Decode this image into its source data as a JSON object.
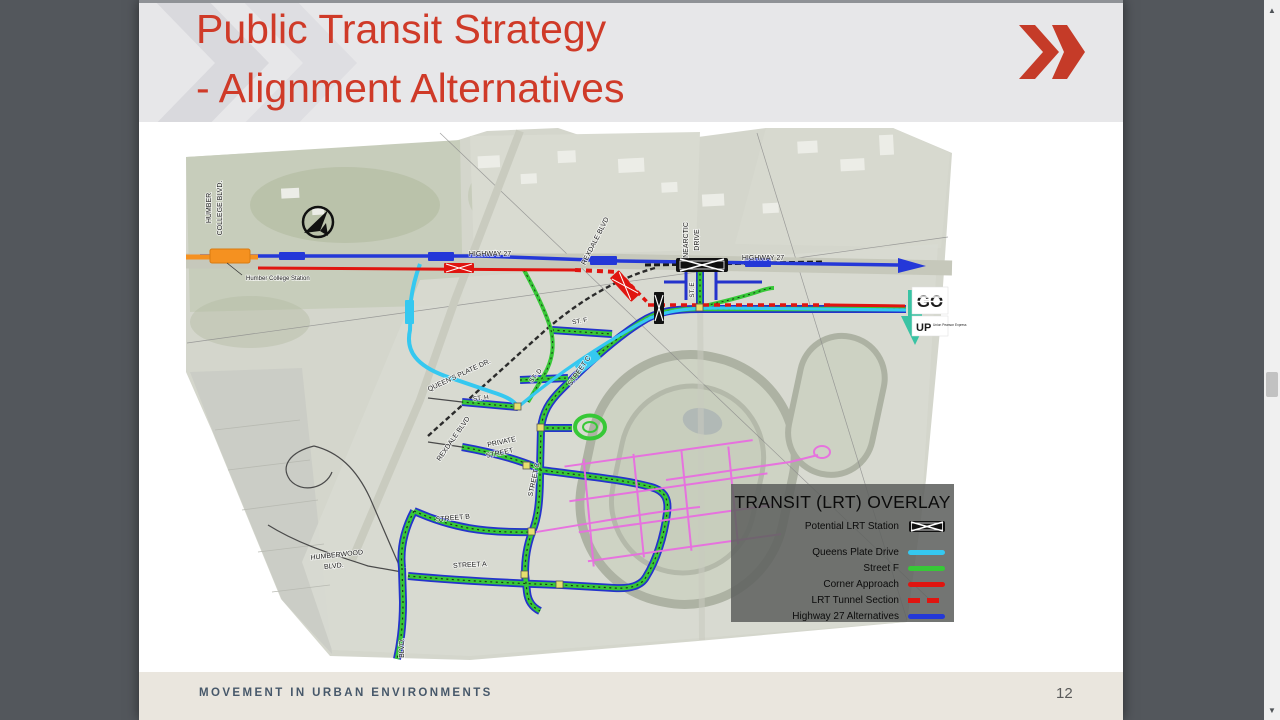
{
  "slide": {
    "title": {
      "line1": "Public Transit Strategy",
      "line2": "- Alignment Alternatives",
      "color": "#cf3a28"
    },
    "footer": {
      "text": "MOVEMENT IN URBAN ENVIRONMENTS",
      "page_number": "12"
    }
  },
  "map": {
    "labels": {
      "humber_line1": "HUMBER",
      "humber_line2": "COLLEGE BLVD.",
      "humber_college_station": "Humber College Station",
      "highway27_west": "HIGHWAY 27",
      "highway27_east": "HIGHWAY 27",
      "rexdale_north": "REXDALE BLVD",
      "rexdale_south": "REXDALE BLVD",
      "nearctic_line1": "NEARCTIC",
      "nearctic_line2": "DRIVE",
      "st_e": "ST. E",
      "st_f": "ST. F",
      "st_d": "ST. D",
      "st_h": "ST. H",
      "street_c_upper": "STREET C",
      "street_c_lower": "STREET C",
      "street_b": "STREET B",
      "street_a": "STREET A",
      "private_line1": "PRIVATE",
      "private_line2": "STREET",
      "queens_plate": "QUEEN'S PLATE DR.",
      "humberwood_line1": "HUMBERWOOD",
      "humberwood_line2": "BLVD.",
      "humberwood_bottom": "BLVD."
    },
    "logos": {
      "go": "GO",
      "up": "UP",
      "up_sub": "Union Pearson Express"
    },
    "colors": {
      "queens_plate_drive": "#35c8f0",
      "street_f": "#37c837",
      "corner_approach": "#e01510",
      "highway27_alternatives": "#2438d8",
      "humber_college_line": "#f59120",
      "future_streets": "#e86ee0",
      "go_green": "#15713c",
      "up_arrow_teal": "#2bc1a0"
    }
  },
  "legend": {
    "title": "TRANSIT (LRT) OVERLAY",
    "items": [
      {
        "label": "Potential LRT Station",
        "symbol": "station",
        "color": "#111111"
      },
      {
        "label": "Queens Plate Drive",
        "symbol": "line",
        "color": "#35c8f0"
      },
      {
        "label": "Street F",
        "symbol": "line",
        "color": "#37c837"
      },
      {
        "label": "Corner Approach",
        "symbol": "line",
        "color": "#e01510"
      },
      {
        "label": "LRT Tunnel Section",
        "symbol": "dashed-line",
        "color": "#e01510"
      },
      {
        "label": "Highway 27 Alternatives",
        "symbol": "line",
        "color": "#2438d8"
      }
    ]
  },
  "icons": {
    "scroll_up": "▲",
    "scroll_down": "▼"
  }
}
